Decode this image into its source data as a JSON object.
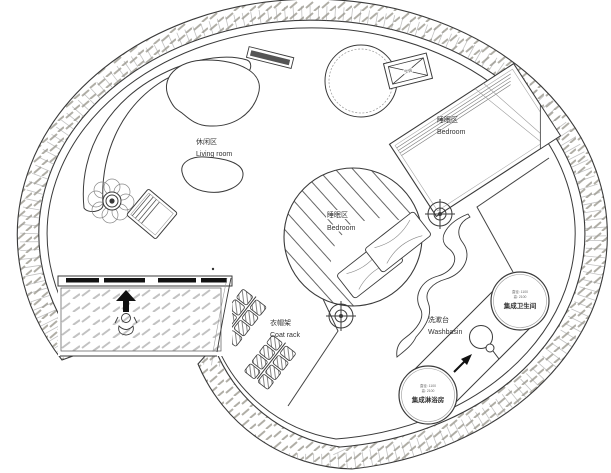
{
  "drawing": "circular-tiny-house-floor-plan",
  "colors": {
    "line": "#3a3a3a",
    "wall_hatch": "#b0aea6",
    "floor_hatch": "#bdbdbd",
    "paper": "#ffffff"
  },
  "labels": {
    "living_zh": "休闲区",
    "living_en": "Living room",
    "bedroom1_zh": "睡眠区",
    "bedroom1_en": "Bedroom",
    "bedroom2_zh": "睡眠区",
    "bedroom2_en": "Bedroom",
    "coatrack_zh": "衣帽架",
    "coatrack_en": "Coat rack",
    "washbasin_zh": "洗漱台",
    "washbasin_en": "Washbasin",
    "bathroom_spec1": "直径: 1100",
    "bathroom_spec2": "高: 2100",
    "bathroom_name": "集成卫生间",
    "shower_spec1": "直径: 1100",
    "shower_spec2": "高: 2100",
    "shower_name": "集成淋浴房",
    "ac": "空调"
  }
}
